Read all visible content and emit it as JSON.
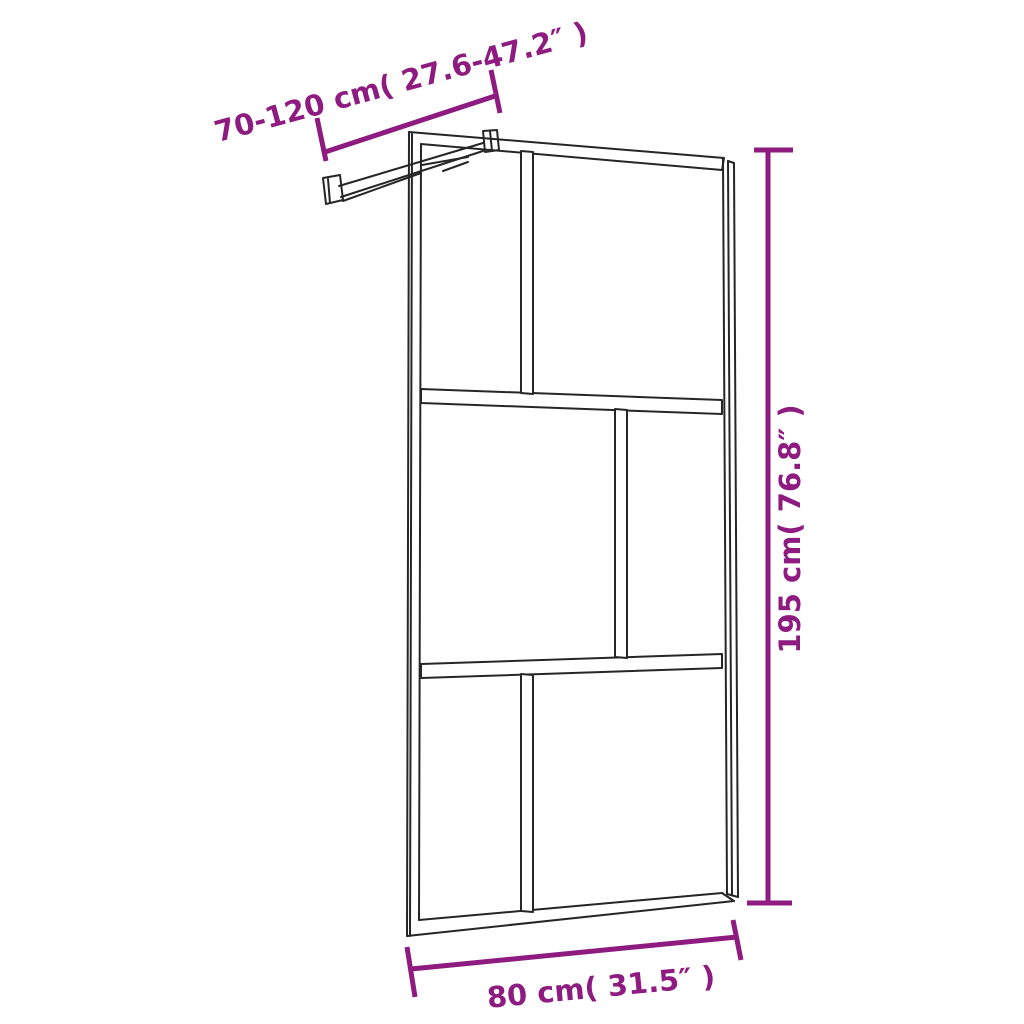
{
  "colors": {
    "line": "#262626",
    "dimension": "#8E1B80",
    "background": "#ffffff",
    "fill": "#ffffff"
  },
  "diagram": {
    "labels": {
      "width_range": "70-120 cm( 27.6-47.2″ )",
      "height": "195 cm( 76.8″ )",
      "width": "80 cm( 31.5″ )"
    }
  }
}
